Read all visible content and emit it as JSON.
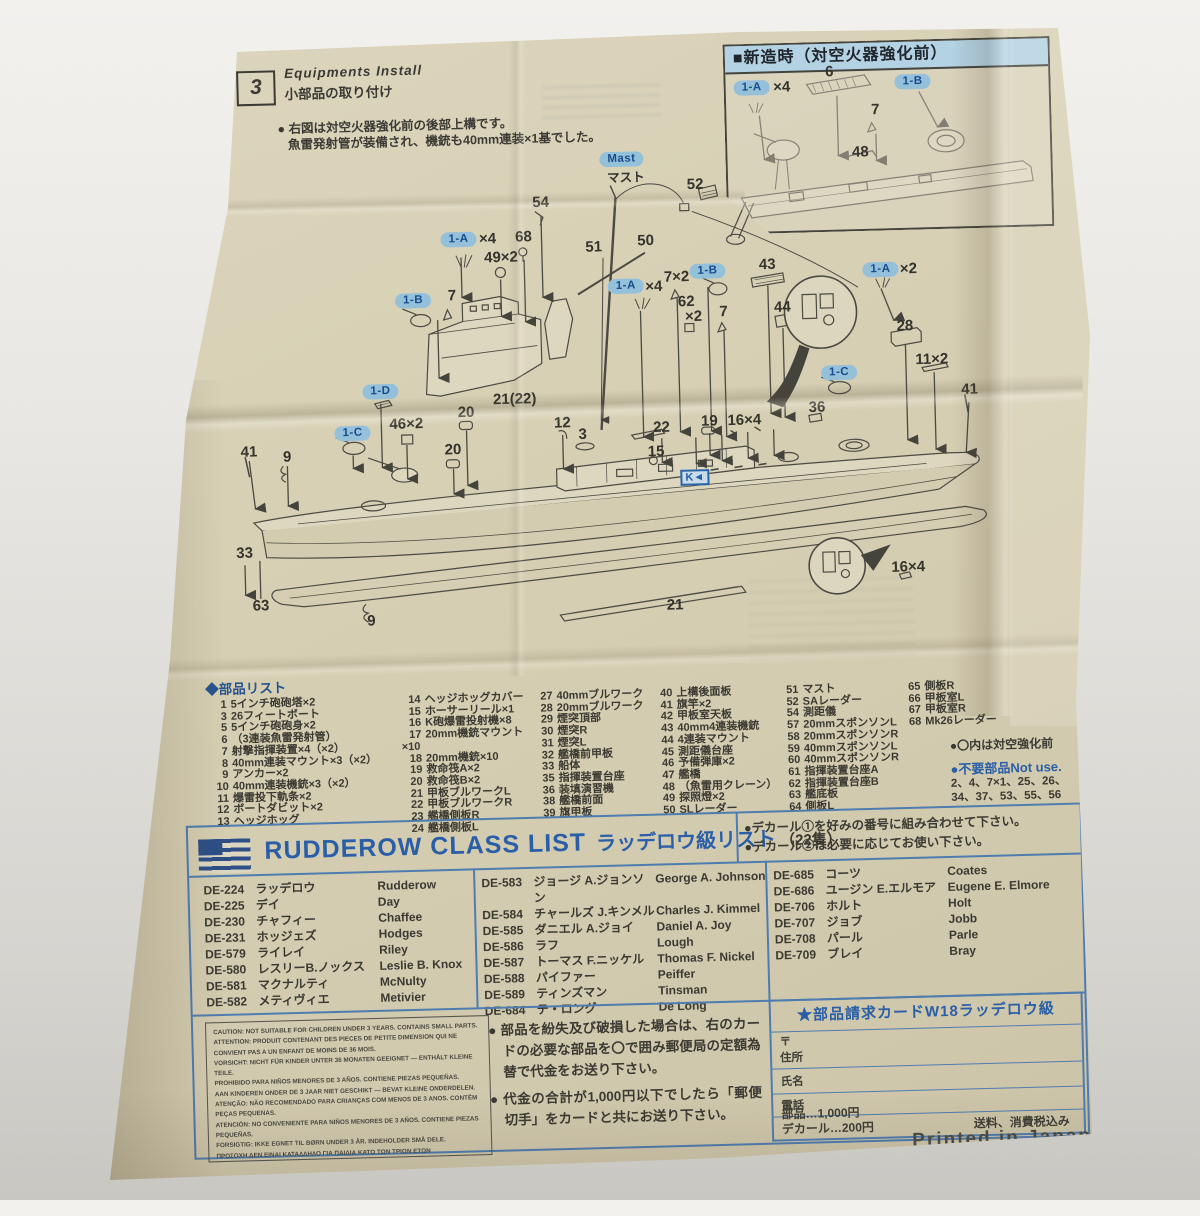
{
  "sec3": {
    "number": "3",
    "title_en": "Equipments Install",
    "title_ja": "小部品の取り付け",
    "note1": "● 右図は対空火器強化前の後部上構です。",
    "note2": "魚雷発射管が装備され、機銃も40mm連装×1基でした。"
  },
  "inset": {
    "title": "■新造時（対空火器強化前）"
  },
  "diagram": {
    "callouts": [
      {
        "t": "1-A",
        "x": 765,
        "y": 92,
        "k": "pill"
      },
      {
        "t": "×4",
        "x": 795,
        "y": 92,
        "k": "num"
      },
      {
        "t": "6",
        "x": 843,
        "y": 78,
        "k": "num"
      },
      {
        "t": "1-B",
        "x": 926,
        "y": 90,
        "k": "pill"
      },
      {
        "t": "7",
        "x": 888,
        "y": 117,
        "k": "num"
      },
      {
        "t": "48",
        "x": 872,
        "y": 159,
        "k": "num"
      },
      {
        "t": "Mast",
        "x": 633,
        "y": 160,
        "k": "pill"
      },
      {
        "t": "マスト",
        "x": 637,
        "y": 177,
        "k": "num2"
      },
      {
        "t": "52",
        "x": 706,
        "y": 187,
        "k": "num"
      },
      {
        "t": "54",
        "x": 551,
        "y": 201,
        "k": "num"
      },
      {
        "t": "68",
        "x": 533,
        "y": 235,
        "k": "num"
      },
      {
        "t": "1-A",
        "x": 468,
        "y": 236,
        "k": "pill"
      },
      {
        "t": "×4",
        "x": 497,
        "y": 236,
        "k": "num"
      },
      {
        "t": "49×2",
        "x": 510,
        "y": 255,
        "k": "num"
      },
      {
        "t": "51",
        "x": 603,
        "y": 247,
        "k": "num"
      },
      {
        "t": "50",
        "x": 655,
        "y": 242,
        "k": "num"
      },
      {
        "t": "1-B",
        "x": 421,
        "y": 296,
        "k": "pill"
      },
      {
        "t": "7",
        "x": 460,
        "y": 292,
        "k": "num"
      },
      {
        "t": "1-A",
        "x": 634,
        "y": 287,
        "k": "pill"
      },
      {
        "t": "×4",
        "x": 662,
        "y": 288,
        "k": "num"
      },
      {
        "t": "7×2",
        "x": 685,
        "y": 279,
        "k": "num"
      },
      {
        "t": "1-B",
        "x": 716,
        "y": 274,
        "k": "pill"
      },
      {
        "t": "43",
        "x": 776,
        "y": 269,
        "k": "num"
      },
      {
        "t": "62",
        "x": 694,
        "y": 304,
        "k": "num"
      },
      {
        "t": "×2",
        "x": 701,
        "y": 319,
        "k": "num"
      },
      {
        "t": "7",
        "x": 731,
        "y": 315,
        "k": "num"
      },
      {
        "t": "44",
        "x": 790,
        "y": 312,
        "k": "num"
      },
      {
        "t": "1-A",
        "x": 889,
        "y": 277,
        "k": "pill"
      },
      {
        "t": "×2",
        "x": 917,
        "y": 277,
        "k": "num"
      },
      {
        "t": "28",
        "x": 912,
        "y": 334,
        "k": "num"
      },
      {
        "t": "11×2",
        "x": 938,
        "y": 368,
        "k": "num"
      },
      {
        "t": "41",
        "x": 975,
        "y": 399,
        "k": "num"
      },
      {
        "t": "1-C",
        "x": 845,
        "y": 379,
        "k": "pill"
      },
      {
        "t": "36",
        "x": 822,
        "y": 413,
        "k": "num"
      },
      {
        "t": "21(22)",
        "x": 520,
        "y": 397,
        "k": "num"
      },
      {
        "t": "1-D",
        "x": 386,
        "y": 386,
        "k": "pill"
      },
      {
        "t": "46×2",
        "x": 411,
        "y": 419,
        "k": "num"
      },
      {
        "t": "20",
        "x": 471,
        "y": 409,
        "k": "num"
      },
      {
        "t": "20",
        "x": 457,
        "y": 446,
        "k": "num"
      },
      {
        "t": "1-C",
        "x": 357,
        "y": 427,
        "k": "pill"
      },
      {
        "t": "12",
        "x": 567,
        "y": 422,
        "k": "num"
      },
      {
        "t": "3",
        "x": 587,
        "y": 434,
        "k": "num"
      },
      {
        "t": "22",
        "x": 666,
        "y": 429,
        "k": "num"
      },
      {
        "t": "19",
        "x": 714,
        "y": 424,
        "k": "num"
      },
      {
        "t": "16×4",
        "x": 749,
        "y": 424,
        "k": "num"
      },
      {
        "t": "15",
        "x": 660,
        "y": 453,
        "k": "num"
      },
      {
        "t": "41",
        "x": 253,
        "y": 443,
        "k": "num"
      },
      {
        "t": "9",
        "x": 291,
        "y": 449,
        "k": "num"
      },
      {
        "t": "33",
        "x": 246,
        "y": 544,
        "k": "num"
      },
      {
        "t": "63",
        "x": 261,
        "y": 597,
        "k": "num"
      },
      {
        "t": "9",
        "x": 371,
        "y": 615,
        "k": "num"
      },
      {
        "t": "16×4",
        "x": 909,
        "y": 575,
        "k": "num"
      },
      {
        "t": "21",
        "x": 675,
        "y": 607,
        "k": "num"
      },
      {
        "t": "K◄",
        "x": 698,
        "y": 480,
        "k": "kbox"
      }
    ]
  },
  "parts_list": {
    "title": "◆部品リスト",
    "columns": [
      [
        {
          "no": "1",
          "name": "5インチ砲砲塔×2"
        },
        {
          "no": "3",
          "name": "26フィートボート"
        },
        {
          "no": "5",
          "name": "5インチ砲砲身×2"
        },
        {
          "no": "6",
          "name": "（3連装魚雷発射管）"
        },
        {
          "no": "7",
          "name": "射撃指揮装置×4（×2）"
        },
        {
          "no": "8",
          "name": "40mm連装マウント×3（×2）"
        },
        {
          "no": "9",
          "name": "アンカー×2"
        },
        {
          "no": "10",
          "name": "40mm連装機銃×3（×2）"
        },
        {
          "no": "11",
          "name": "爆雷投下軌条×2"
        },
        {
          "no": "12",
          "name": "ボートダビット×2"
        },
        {
          "no": "13",
          "name": "ヘッジホッグ"
        }
      ],
      [
        {
          "no": "14",
          "name": "ヘッジホッグカバー"
        },
        {
          "no": "15",
          "name": "ホーサーリール×1"
        },
        {
          "no": "16",
          "name": "K砲爆雷投射機×8"
        },
        {
          "no": "17",
          "name": "20mm機銃マウント×10"
        },
        {
          "no": "18",
          "name": "20mm機銃×10"
        },
        {
          "no": "19",
          "name": "救命筏A×2"
        },
        {
          "no": "20",
          "name": "救命筏B×2"
        },
        {
          "no": "21",
          "name": "甲板ブルワークL"
        },
        {
          "no": "22",
          "name": "甲板ブルワークR"
        },
        {
          "no": "23",
          "name": "艦橋側板R"
        },
        {
          "no": "24",
          "name": "艦橋側板L"
        }
      ],
      [
        {
          "no": "27",
          "name": "40mmブルワーク"
        },
        {
          "no": "28",
          "name": "20mmブルワーク"
        },
        {
          "no": "29",
          "name": "煙突頂部"
        },
        {
          "no": "30",
          "name": "煙突R"
        },
        {
          "no": "31",
          "name": "煙突L"
        },
        {
          "no": "32",
          "name": "艦橋前甲板"
        },
        {
          "no": "33",
          "name": "船体"
        },
        {
          "no": "35",
          "name": "指揮装置台座"
        },
        {
          "no": "36",
          "name": "装填演習機"
        },
        {
          "no": "38",
          "name": "艦橋前面"
        },
        {
          "no": "39",
          "name": "旗甲板"
        }
      ],
      [
        {
          "no": "40",
          "name": "上構後面板"
        },
        {
          "no": "41",
          "name": "旗竿×2"
        },
        {
          "no": "42",
          "name": "甲板室天板"
        },
        {
          "no": "43",
          "name": "40mm4連装機銃"
        },
        {
          "no": "44",
          "name": "4連装マウント"
        },
        {
          "no": "45",
          "name": "測距儀台座"
        },
        {
          "no": "46",
          "name": "予備弾庫×2"
        },
        {
          "no": "47",
          "name": "艦橋"
        },
        {
          "no": "48",
          "name": "（魚雷用クレーン）"
        },
        {
          "no": "49",
          "name": "探照燈×2"
        },
        {
          "no": "50",
          "name": "SLレーダー"
        }
      ],
      [
        {
          "no": "51",
          "name": "マスト"
        },
        {
          "no": "52",
          "name": "SAレーダー"
        },
        {
          "no": "54",
          "name": "測距儀"
        },
        {
          "no": "57",
          "name": "20mmスポンソンL"
        },
        {
          "no": "58",
          "name": "20mmスポンソンR"
        },
        {
          "no": "59",
          "name": "40mmスポンソンL"
        },
        {
          "no": "60",
          "name": "40mmスポンソンR"
        },
        {
          "no": "61",
          "name": "指揮装置台座A"
        },
        {
          "no": "62",
          "name": "指揮装置台座B"
        },
        {
          "no": "63",
          "name": "艦底板"
        },
        {
          "no": "64",
          "name": "側板L"
        }
      ],
      [
        {
          "no": "65",
          "name": "側板R"
        },
        {
          "no": "66",
          "name": "甲板室L"
        },
        {
          "no": "67",
          "name": "甲板室R"
        },
        {
          "no": "68",
          "name": "Mk26レーダー"
        }
      ]
    ],
    "note_marked": "●〇内は対空強化前",
    "note_notuse": "●不要部品Not use.",
    "note_numbers1": "2、4、7×1、25、26、",
    "note_numbers2": "34、37、53、55、56"
  },
  "class_list": {
    "title_en": "RUDDEROW CLASS LIST",
    "title_ja": "ラッデロウ級リスト",
    "count": "（22隻）",
    "decal_notes": [
      "●デカール①を好みの番号に組み合わせて下さい。",
      "●デカール②は必要に応じてお使い下さい。"
    ],
    "groups": [
      [
        {
          "de": "DE-224",
          "ja": "ラッデロウ",
          "en": "Rudderow"
        },
        {
          "de": "DE-225",
          "ja": "デイ",
          "en": "Day"
        },
        {
          "de": "DE-230",
          "ja": "チャフィー",
          "en": "Chaffee"
        },
        {
          "de": "DE-231",
          "ja": "ホッジェズ",
          "en": "Hodges"
        },
        {
          "de": "DE-579",
          "ja": "ライレイ",
          "en": "Riley"
        },
        {
          "de": "DE-580",
          "ja": "レスリーB.ノックス",
          "en": "Leslie B. Knox"
        },
        {
          "de": "DE-581",
          "ja": "マクナルティ",
          "en": "McNulty"
        },
        {
          "de": "DE-582",
          "ja": "メティヴィエ",
          "en": "Metivier"
        }
      ],
      [
        {
          "de": "DE-583",
          "ja": "ジョージ A.ジョンソン",
          "en": "George A. Johnson"
        },
        {
          "de": "DE-584",
          "ja": "チャールズ J.キンメル",
          "en": "Charles J. Kimmel"
        },
        {
          "de": "DE-585",
          "ja": "ダニエル A.ジョイ",
          "en": "Daniel A. Joy"
        },
        {
          "de": "DE-586",
          "ja": "ラフ",
          "en": "Lough"
        },
        {
          "de": "DE-587",
          "ja": "トーマス F.ニッケル",
          "en": "Thomas F. Nickel"
        },
        {
          "de": "DE-588",
          "ja": "パイファー",
          "en": "Peiffer"
        },
        {
          "de": "DE-589",
          "ja": "ティンズマン",
          "en": "Tinsman"
        },
        {
          "de": "DE-684",
          "ja": "テ・ロング",
          "en": "De Long"
        }
      ],
      [
        {
          "de": "DE-685",
          "ja": "コーツ",
          "en": "Coates"
        },
        {
          "de": "DE-686",
          "ja": "ユージン E.エルモア",
          "en": "Eugene E. Elmore"
        },
        {
          "de": "DE-706",
          "ja": "ホルト",
          "en": "Holt"
        },
        {
          "de": "DE-707",
          "ja": "ジョブ",
          "en": "Jobb"
        },
        {
          "de": "DE-708",
          "ja": "パール",
          "en": "Parle"
        },
        {
          "de": "DE-709",
          "ja": "ブレイ",
          "en": "Bray"
        }
      ]
    ]
  },
  "bottom": {
    "caution_lines": [
      "CAUTION: NOT SUITABLE FOR CHILDREN UNDER 3 YEARS. CONTAINS SMALL PARTS.",
      "ATTENTION: PRODUIT CONTENANT DES PIECES DE PETITE DIMENSION QUI NE CONVIENT PAS A UN ENFANT DE MOINS DE 36 MOIS.",
      "VORSICHT: NICHT FÜR KINDER UNTER 36 MONATEN GEEIGNET — ENTHÄLT KLEINE TEILE.",
      "PROHIBIDO PARA NIÑOS MENORES DE 3 AÑOS. CONTIENE PIEZAS PEQUEÑAS.",
      "AAN KINDEREN ONDER DE 3 JAAR NIET GESCHIKT — BEVAT KLEINE ONDERDELEN.",
      "ATENÇÃO: NÃO RECOMENDADO PARA CRIANÇAS COM MENOS DE 3 ANOS. CONTÉM PEÇAS PEQUENAS.",
      "ATENCIÓN: NO CONVENIENTE PARA NIÑOS MENORES DE 3 AÑOS. CONTIENE PIEZAS PEQUEÑAS.",
      "FORSIGTIG: IKKE EGNET TIL BØRN UNDER 3 ÅR. INDEHOLDER SMÅ DELE.",
      "ΠΡΟΣΟΧΗ ΔΕΝ ΕΙΝΑΙ ΚΑΤΑΛΛΗΛΟ ΓΙΑ ΠΑΙΔΙΑ ΚΑΤΩ ΤΩΝ ΤΡΙΩΝ ΕΤΩΝ",
      "ΠΕΡΙΕΧΕΙ ΜΙΚΡΑ ΤΕΜΑΧΙΑ."
    ],
    "instructions": [
      "● 部品を紛失及び破損した場合は、右のカードの必要な部品を〇で囲み郵便局の定額為替で代金をお送り下さい。",
      "● 代金の合計が1,000円以下でしたら「郵便切手」をカードと共にお送り下さい。"
    ],
    "card": {
      "title": "★部品請求カードW18ラッデロウ級",
      "postal": "〒",
      "address": "住所",
      "name": "氏名",
      "phone": "電話",
      "price1": "部品…1,000円",
      "price2": "デカール…200円",
      "tax": "送料、消費税込み"
    }
  },
  "printed_in": "Printed in Japan"
}
